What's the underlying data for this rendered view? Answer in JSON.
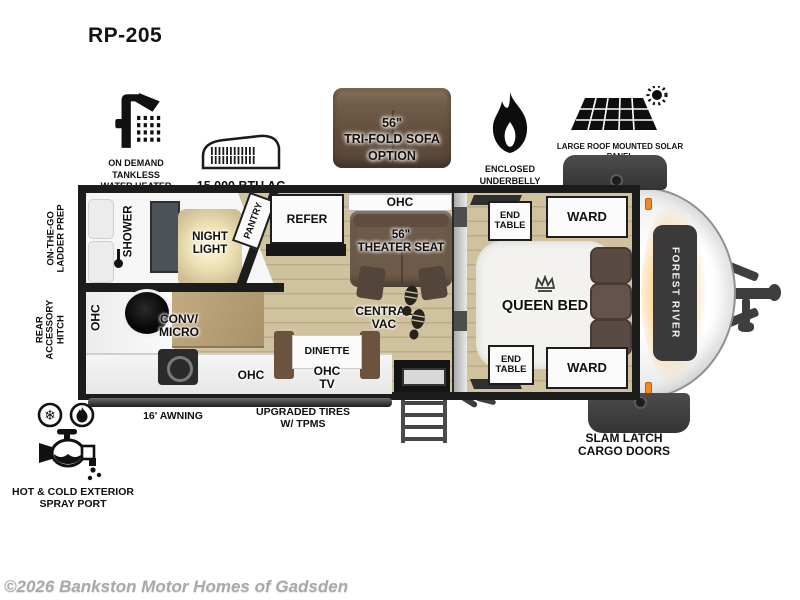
{
  "page": {
    "title": "RP-205",
    "watermark": "©2026 Bankston Motor Homes of Gadsden"
  },
  "features": [
    {
      "name": "on-demand-tankless-water-heater",
      "label": "ON DEMAND\nTANKLESS\nWATER HEATER"
    },
    {
      "name": "air-conditioner",
      "label": "15,000 BTU AC"
    },
    {
      "name": "tri-fold-sofa-option",
      "label": "56\"\nTRI-FOLD SOFA\nOPTION"
    },
    {
      "name": "enclosed-underbelly-forced-heat",
      "label": "ENCLOSED UNDERBELLY\nWITH FORCED HEAT"
    },
    {
      "name": "roof-solar-panel",
      "label": "LARGE ROOF MOUNTED SOLAR PANEL\n30 AMP CONTROLLER & INVERTER PREP"
    }
  ],
  "floorplan": {
    "brand": "FOREST RIVER",
    "rooms": {
      "shower": "SHOWER",
      "night_light": "NIGHT\nLIGHT",
      "pantry": "PANTRY",
      "refer": "REFER",
      "ohc_top": "OHC",
      "theater_seat": "56\"\nTHEATER SEAT",
      "central_vac": "CENTRAL\nVAC",
      "ohc_left": "OHC",
      "conv_micro": "CONV/\nMICRO",
      "dinette": "DINETTE",
      "ohc_tv": "OHC\nTV",
      "ohc_bottom": "OHC",
      "queen_bed": "QUEEN BED",
      "end_table_top": "END\nTABLE",
      "end_table_bottom": "END\nTABLE",
      "ward_top": "WARD",
      "ward_bottom": "WARD"
    },
    "callouts": {
      "ladder_prep": "ON-THE-GO\nLADDER PREP",
      "rear_hitch": "REAR\nACCESSORY\nHITCH",
      "awning": "16' AWNING",
      "tires": "UPGRADED TIRES\nW/ TPMS",
      "cargo_doors": "SLAM LATCH\nCARGO DOORS",
      "spray_port": "HOT & COLD EXTERIOR\nSPRAY PORT"
    }
  },
  "colors": {
    "wall": "#1c1c1c",
    "wood_floor": "#d0c19f",
    "seat_brown": "#6b5846",
    "accent_orange": "#f6a71c"
  }
}
